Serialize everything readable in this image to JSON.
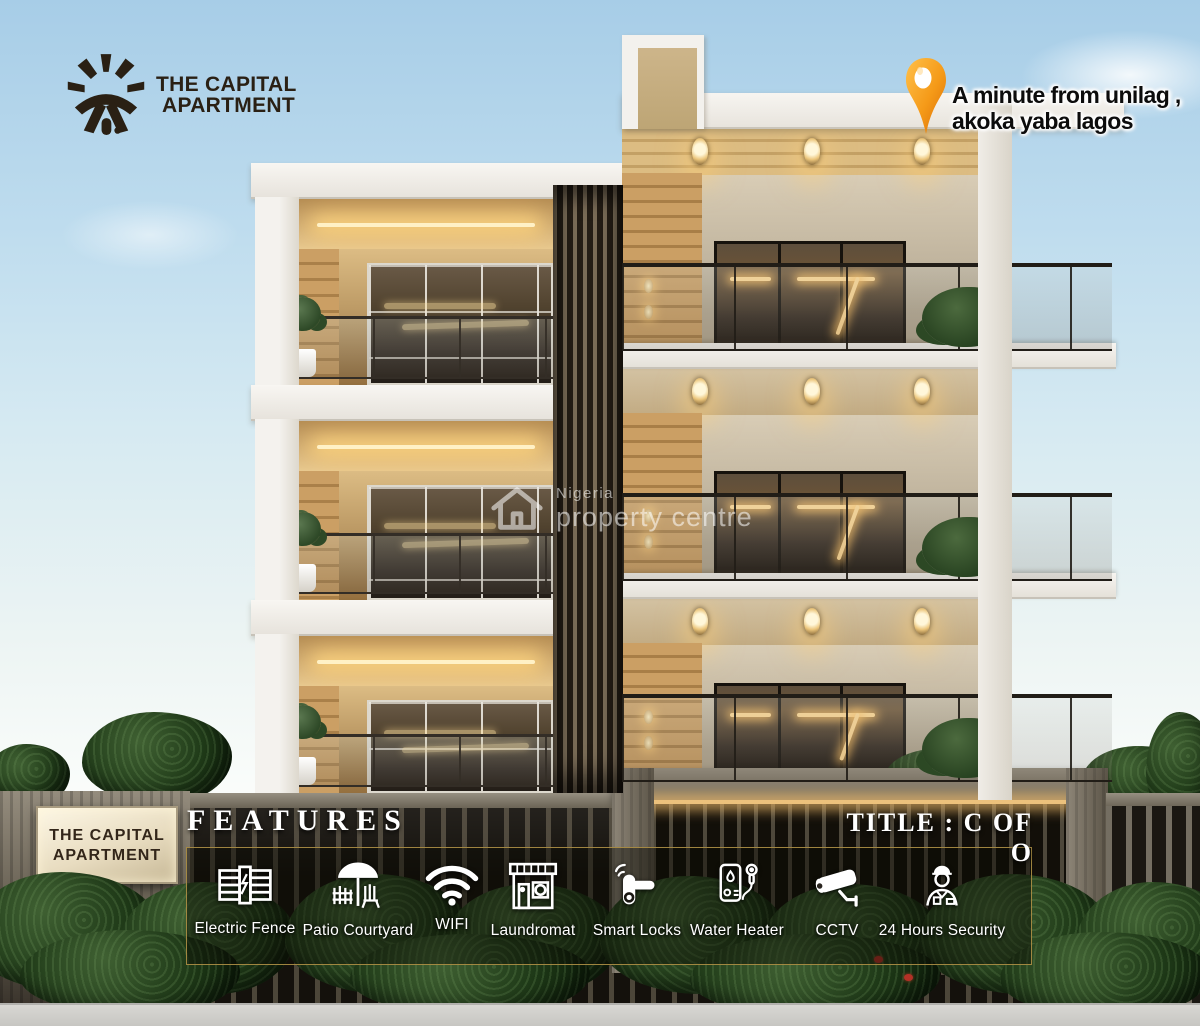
{
  "brand": {
    "line1": "THE CAPITAL",
    "line2": "APARTMENT"
  },
  "location": {
    "line1": "A minute from unilag ,",
    "line2": "akoka yaba lagos"
  },
  "watermark": {
    "line1": "Nigeria",
    "line2": "property centre"
  },
  "signboard": {
    "line1": "THE CAPITAL",
    "line2": "APARTMENT"
  },
  "features": {
    "heading": "FEATURES",
    "title_right": "TITLE : C OF O",
    "items": [
      {
        "label": "Electric Fence",
        "icon": "electric-fence-icon"
      },
      {
        "label": "Patio Courtyard",
        "icon": "patio-courtyard-icon"
      },
      {
        "label": "WIFI",
        "icon": "wifi-icon"
      },
      {
        "label": "Laundromat",
        "icon": "laundromat-icon"
      },
      {
        "label": "Smart Locks",
        "icon": "smart-locks-icon"
      },
      {
        "label": "Water Heater",
        "icon": "water-heater-icon"
      },
      {
        "label": "CCTV",
        "icon": "cctv-icon"
      },
      {
        "label": "24 Hours Security",
        "icon": "security-guard-icon"
      }
    ]
  },
  "colors": {
    "pin_orange": "#f59a18",
    "led_warm": "#ffd892",
    "panel_gold_border": "#af9146",
    "brand_brown": "#2a2014"
  }
}
